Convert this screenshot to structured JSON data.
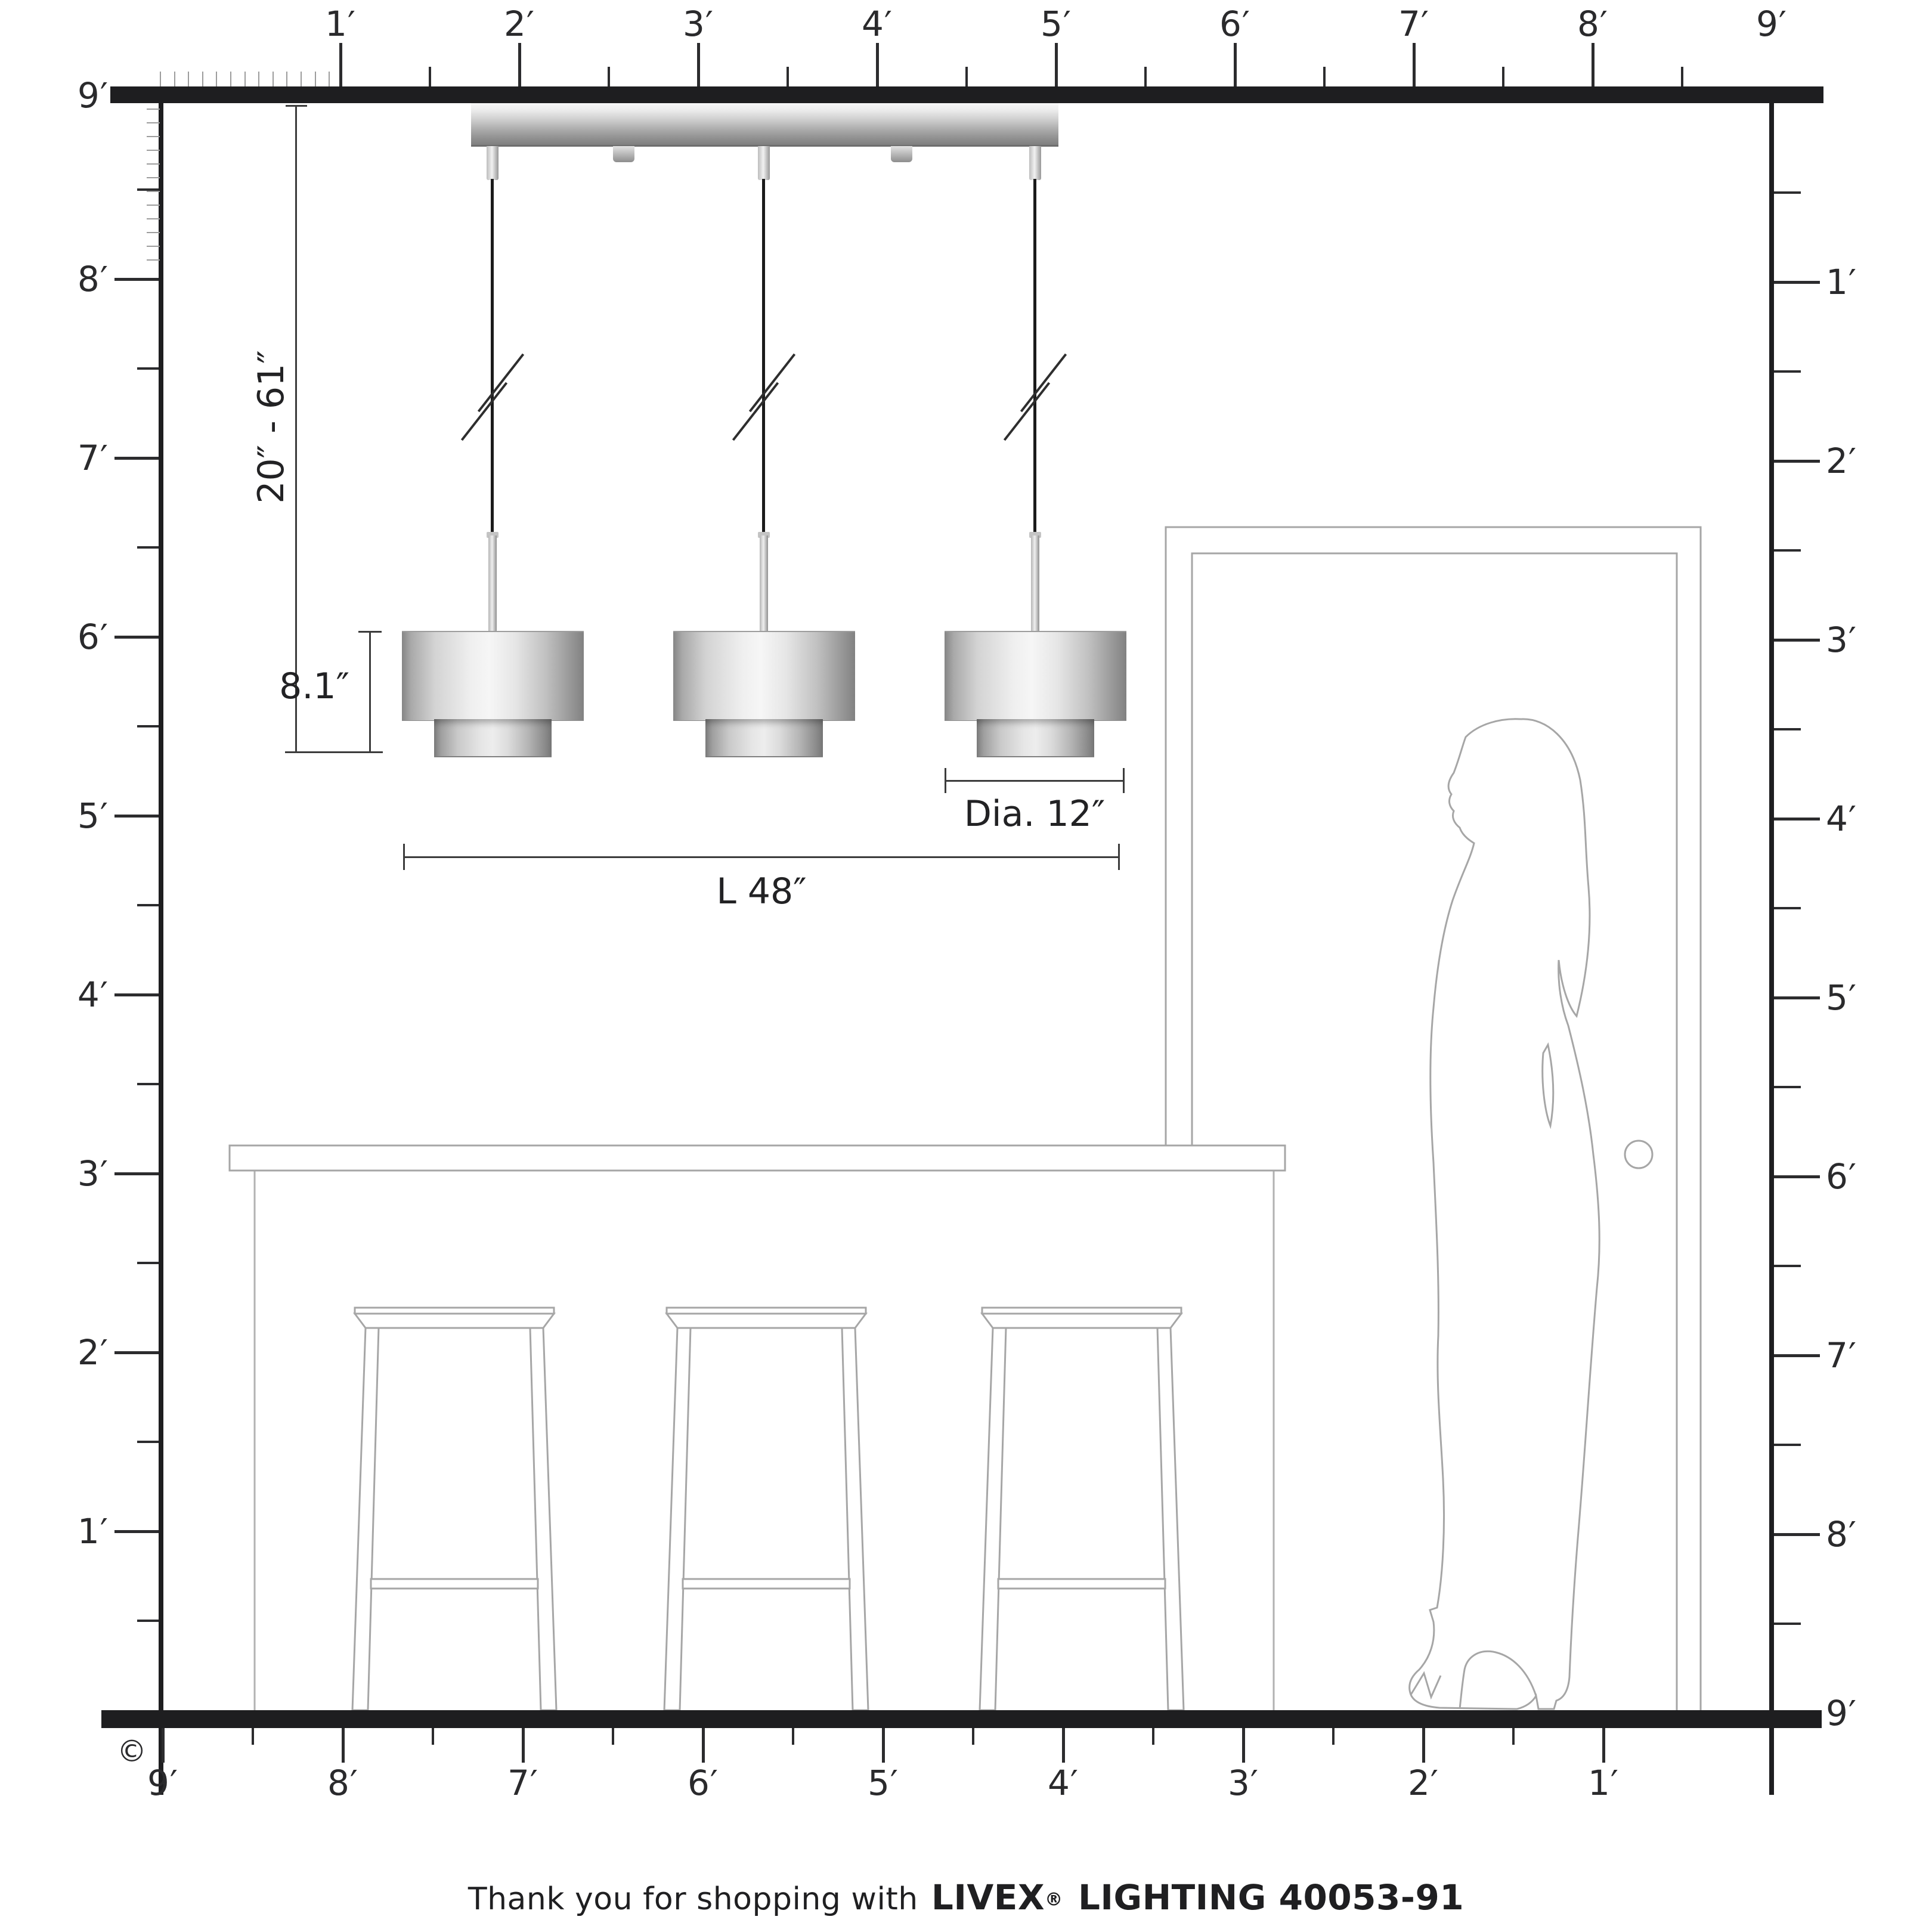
{
  "rulers": {
    "top": [
      "1′",
      "2′",
      "3′",
      "4′",
      "5′",
      "6′",
      "7′",
      "8′",
      "9′"
    ],
    "left": [
      "9′",
      "8′",
      "7′",
      "6′",
      "5′",
      "4′",
      "3′",
      "2′",
      "1′"
    ],
    "right": [
      "1′",
      "2′",
      "3′",
      "4′",
      "5′",
      "6′",
      "7′",
      "8′",
      "9′"
    ],
    "bottom": [
      "9′",
      "8′",
      "7′",
      "6′",
      "5′",
      "4′",
      "3′",
      "2′",
      "1′"
    ],
    "unit": "feet"
  },
  "dimensions": {
    "hanging_range": "20″ - 61″",
    "shade_height": "8.1″",
    "shade_diameter": "Dia. 12″",
    "fixture_length": "L 48″"
  },
  "fixture": {
    "pendant_count": 3,
    "style": "two-tier drum pendants on linear canopy"
  },
  "footer": {
    "thanks": "Thank you for shopping with",
    "brand": "LIVEX",
    "registered_mark": "®",
    "product": "LIGHTING 40053-91"
  },
  "copyright_symbol": "©",
  "colors": {
    "ruler": "#1e1e20",
    "dimension_line": "#3c3c3c",
    "label_text": "#2a2a2c",
    "furniture_outline": "#a6a6a6",
    "metal_light": "#f0f0f0",
    "metal_dark": "#808080",
    "cable": "#1b1b1b",
    "background": "#ffffff"
  }
}
